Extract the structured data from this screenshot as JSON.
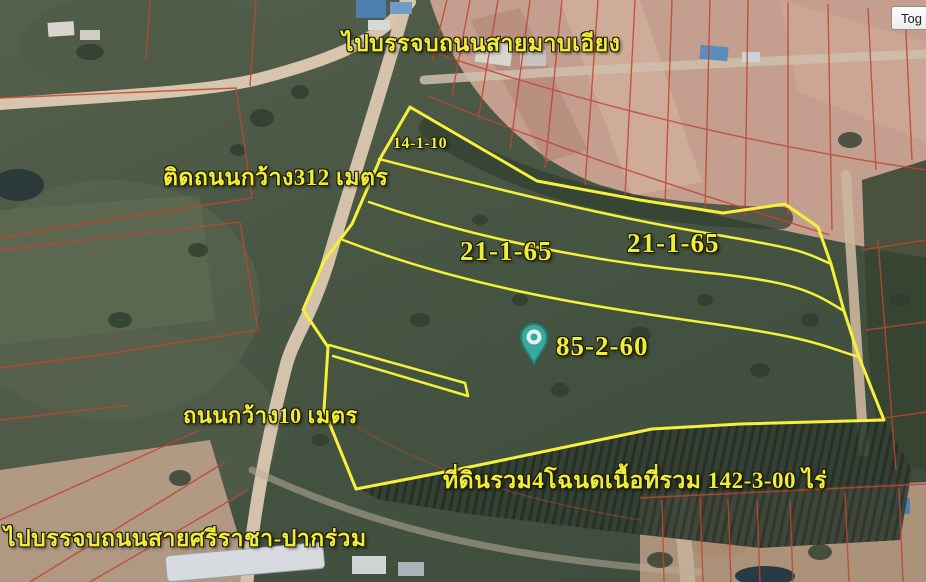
{
  "map": {
    "type": "satellite-aerial-with-land-survey-overlay",
    "labels": {
      "top_road": "ไปบรรจบถนนสายมาบเอียง",
      "west_road": "ติดถนนกว้าง312 เมตร",
      "spur_road": "ถนนกว้าง10 เมตร",
      "bottom_road": "ไปบรรจบถนนสายศรีราชา-ปากร่วม",
      "total_area": "ที่ดินรวม4โฉนดเนื้อที่รวม  142-3-00 ไร่"
    },
    "parcels": [
      {
        "name": "parcel-north-sliver",
        "area": "14-1-10"
      },
      {
        "name": "parcel-strip-west",
        "area": "21-1-65"
      },
      {
        "name": "parcel-strip-east",
        "area": "21-1-65"
      },
      {
        "name": "parcel-main-south",
        "area": "85-2-60"
      }
    ],
    "pin": {
      "shape": "teardrop-map-pin",
      "color": "#3aa89c"
    },
    "colors": {
      "annotation_yellow": "#f5f03a",
      "cadastral_red": "#c1452f",
      "pin_teal": "#3aa89c",
      "road_tan": "#d5c2aa"
    }
  },
  "controls": {
    "toggle_button_label": "Tog"
  }
}
